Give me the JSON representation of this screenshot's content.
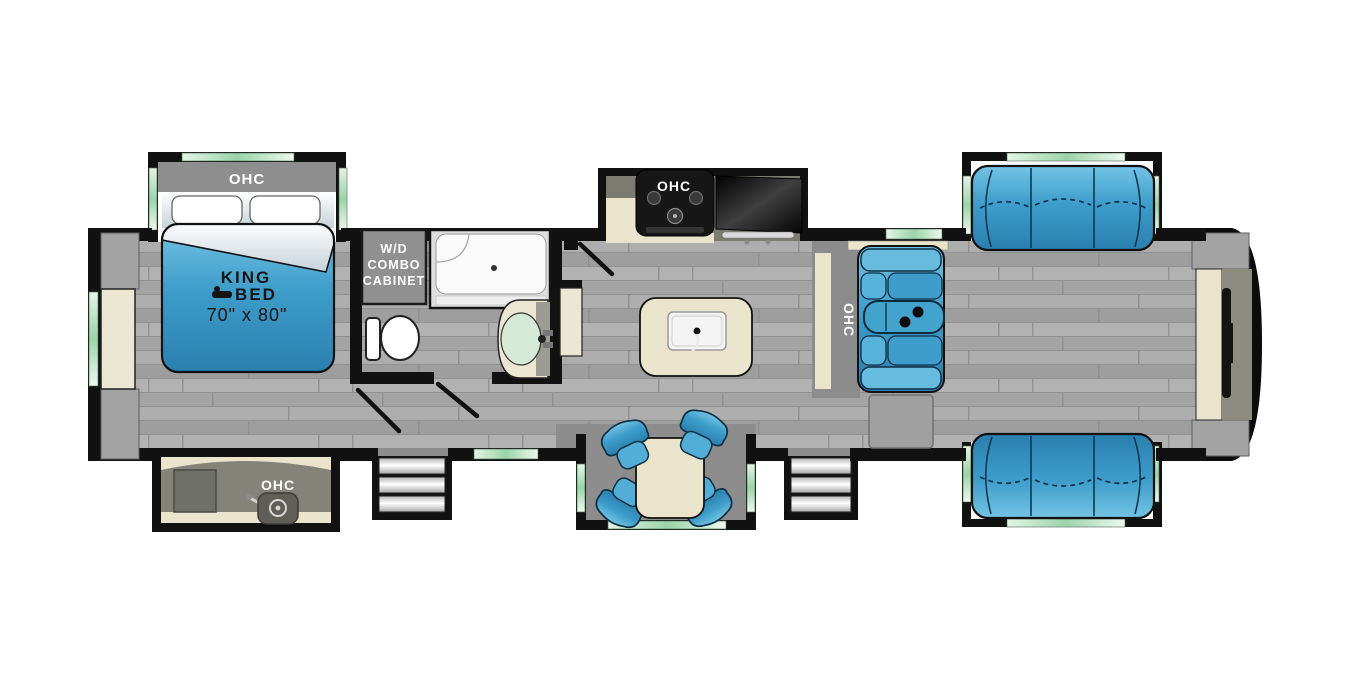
{
  "labels": {
    "bedroom_ohc": "OHC",
    "king_bed_line1": "KING",
    "king_bed_line2": "BED",
    "king_bed_dimensions": "70\" x 80\"",
    "wd_line1": "W/D",
    "wd_line2": "COMBO",
    "wd_line3": "CABINET",
    "kitchen_ohc": "OHC",
    "living_ohc": "OHC",
    "outside_kitchen_ohc": "OHC"
  },
  "colors": {
    "walls": "#111111",
    "floor_gray": "#a7a7a7",
    "furniture_blue": "#3e9dca",
    "cabinet_cream": "#eae4cd",
    "window_green": "#9bd4aa",
    "slide_floor_gray": "#8d8d8d",
    "background": "#ffffff"
  }
}
